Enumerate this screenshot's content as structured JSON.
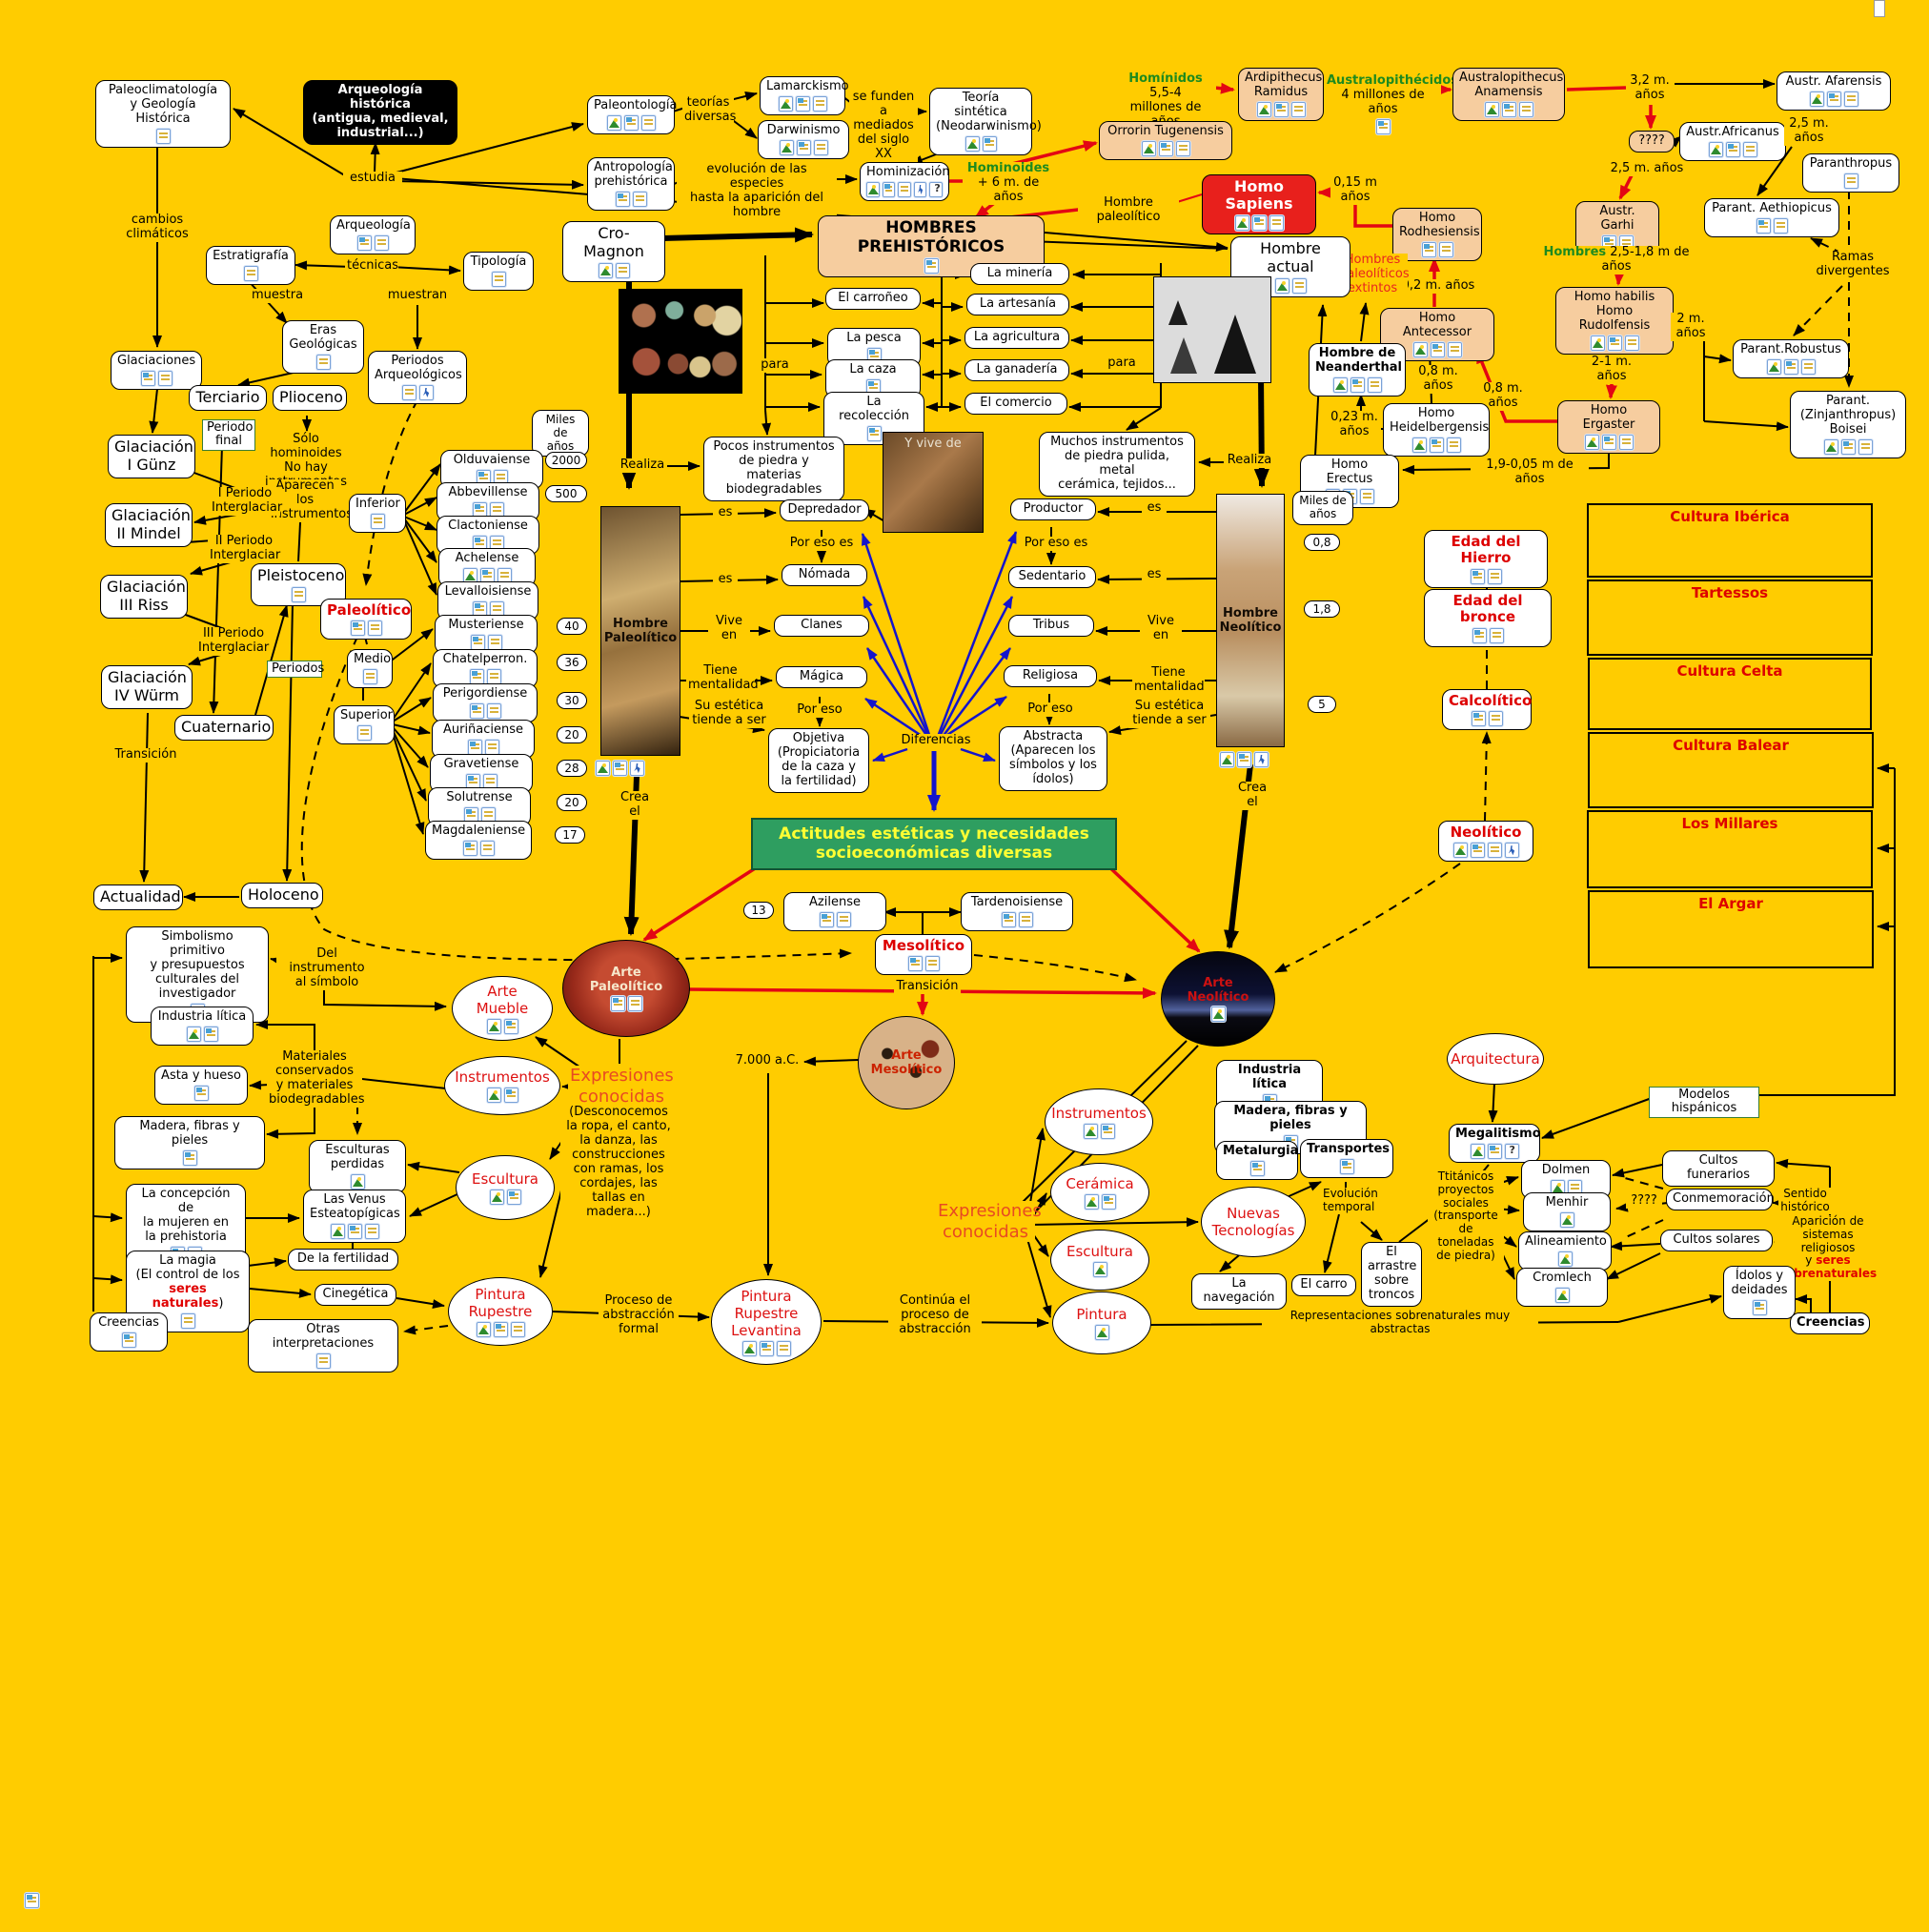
{
  "palette": {
    "background": "#FFCC00",
    "node_fill": "#FFFFFF",
    "peach": "#F6CD9F",
    "red_box": "#E8201C",
    "red_text": "#DD0000",
    "green_text": "#1E8A1E",
    "green_box": "#2E9E60",
    "green_box_text": "#FFFF33",
    "orange_text": "#E84A22",
    "blue_arrow": "#1414CC",
    "red_arrow": "#E30613"
  },
  "tl": {
    "paleoclimatologia": "Paleoclimatología\ny Geología Histórica",
    "arqueologia_historica": "Arqueología histórica\n(antigua, medieval,\nindustrial...)",
    "estudia": "estudia",
    "arqueologia": "Arqueología",
    "tecnicas": "técnicas",
    "estratigrafia": "Estratigrafía",
    "tipologia": "Tipología",
    "muestra": "muestra",
    "muestran": "muestran",
    "cambios": "cambios\nclimáticos",
    "paleontologia": "Paleontología",
    "teorias": "teorías\ndiversas",
    "lamarckismo": "Lamarckismo",
    "darwinismo": "Darwinismo",
    "se_funden": "se funden\na mediados\ndel siglo XX",
    "teoria_sintetica": "Teoría sintética\n(Neodarwinismo)",
    "antropologia": "Antropología\nprehistórica",
    "evolucion": "evolución de las especies\nhasta la aparición del hombre",
    "hominizacion": "Hominización",
    "hominoides_g": "Hominoides",
    "hominoides_r": "+ 6 m. de años",
    "cro_magnon": "Cro-Magnon"
  },
  "ho": {
    "hominidos_g": "Homínidos",
    "hominidos_r1": " 5,5-4",
    "hominidos_r2": "millones de años",
    "ardipithecus": "Ardipithecus\nRamidus",
    "australopithecidos_g": "Australopithécidos",
    "australopithecidos_r": "4 millones de años",
    "anamensis": "Australopithecus\nAnamensis",
    "orrorin": "Orrorin Tugenensis",
    "l_32": "3,2 m.\naños",
    "afarensis": "Austr. Afarensis",
    "q4": "????",
    "l_25a": "2,5 m. años",
    "africanus": "Austr.Africanus",
    "l_25b": "2,5 m.\naños",
    "paranthropus": "Paranthropus",
    "aethiopicus": "Parant. Aethiopicus",
    "ramas": "Ramas\ndivergentes",
    "garhi": "Austr. Garhi",
    "hombres_g": "Hombres",
    "hombres_r": " 2,5-1,8 m de años",
    "habilis": "Homo habilis\nHomo Rudolfensis",
    "l_2m": "2 m.\naños",
    "robustus": "Parant.Robustus",
    "l_21": "2-1 m. años",
    "ergaster": "Homo Ergaster",
    "boisei": "Parant.\n(Zinjanthropus)\nBoisei",
    "l_19": "1,9-0,05 m de años",
    "homo_sapiens": "Homo Sapiens",
    "l_015": "0,15 m\naños",
    "rodhesiensis": "Homo\nRodhesiensis",
    "l_02": "0,2 m. años",
    "antecessor": "Homo Antecessor",
    "l_08a": "0,8 m. años",
    "l_08b": "0,8 m. años",
    "neanderthal": "Hombre de\nNeanderthal",
    "l_023": "0,23 m.\naños",
    "heidelbergensis": "Homo\nHeidelbergensis",
    "erectus": "Homo Erectus",
    "extintos": "Hombres\npaleolíticos\nextintos",
    "hombre_actual": "Hombre actual",
    "hombre_paleolitico": "Hombre paleolítico"
  },
  "gl": {
    "glaciaciones": "Glaciaciones",
    "eras": "Eras\nGeológicas",
    "periodos_arq": "Periodos\nArqueológicos",
    "terciario": "Terciario",
    "plioceno": "Plioceno",
    "periodo_final": "Periodo\nfinal",
    "solo_hominoides": "Sólo hominoides\nNo hay\ninstrumentos",
    "aparecen": "Aparecen los\ninstrumentos",
    "g1": "Glaciación\nI Günz",
    "ip1": "I Periodo\nInterglaciar",
    "g2": "Glaciación\nII Mindel",
    "ip2": "II Periodo\nInterglaciar",
    "g3": "Glaciación\nIII Riss",
    "ip3": "III Periodo\nInterglaciar",
    "g4": "Glaciación\nIV Würm",
    "pleistoceno": "Pleistoceno",
    "periodos": "Periodos",
    "paleolitico": "Paleolítico",
    "inferior": "Inferior",
    "medio": "Medio",
    "superior": "Superior",
    "cuaternario": "Cuaternario",
    "transicion": "Transición",
    "actualidad": "Actualidad",
    "holoceno": "Holoceno"
  },
  "ind": {
    "miles": "Miles de\naños",
    "items": [
      "Olduvaiense",
      "Abbevillense",
      "Clactoniense",
      "Achelense",
      "Levalloisiense",
      "Musteriense",
      "Chatelperron.",
      "Perigordiense",
      "Auriñaciense",
      "Gravetiense",
      "Solutrense",
      "Magdaleniense"
    ],
    "n2000": "2000",
    "n500": "500",
    "n40": "40",
    "n36": "36",
    "n30": "30",
    "n20a": "20",
    "n28": "28",
    "n20b": "20",
    "n17": "17"
  },
  "men": {
    "titulo": "HOMBRES PREHISTÓRICOS",
    "mineria": "La minería",
    "carroneo": "El carroñeo",
    "artesania": "La artesanía",
    "pesca": "La pesca",
    "agricultura": "La agricultura",
    "caza": "La caza",
    "ganaderia": "La ganadería",
    "recoleccion": "La recolección",
    "comercio": "El comercio",
    "para_l": "para",
    "para_r": "para"
  },
  "ls": {
    "pocos": "Pocos instrumentos\nde piedra y materias\nbiodegradables",
    "muchos": "Muchos instrumentos\nde piedra pulida, metal\ncerámica, tejidos...",
    "realiza_l": "Realiza",
    "realiza_r": "Realiza",
    "vive_de": "Y vive de",
    "es_l1": "es",
    "es_l2": "es",
    "es_r1": "es",
    "es_r2": "es",
    "depredador": "Depredador",
    "productor": "Productor",
    "por_eso_es_l": "Por eso es",
    "por_eso_es_r": "Por eso es",
    "nomada": "Nómada",
    "sedentario": "Sedentario",
    "vive_l": "Vive\nen",
    "vive_r": "Vive\nen",
    "clanes": "Clanes",
    "tribus": "Tribus",
    "tiene_l": "Tiene\nmentalidad",
    "tiene_r": "Tiene\nmentalidad",
    "magica": "Mágica",
    "religiosa": "Religiosa",
    "por_eso_l": "Por eso",
    "por_eso_r": "Por eso",
    "estetica_l": "Su estética\ntiende a ser",
    "estetica_r": "Su estética\ntiende a ser",
    "objetiva": "Objetiva\n(Propiciatoria\nde la caza y\nla fertilidad)",
    "abstracta": "Abstracta\n(Aparecen los\nsímbolos y los\nídolos)",
    "diferencias": "Diferencias",
    "crea_l": "Crea\nel",
    "crea_r": "Crea\nel",
    "strip_p": "Hombre\nPaleolítico",
    "strip_n": "Hombre\nNeolítico",
    "miles_r": "Miles de\naños",
    "n08": "0,8",
    "n18": "1,8",
    "n5": "5"
  },
  "ages": {
    "hierro": "Edad del Hierro",
    "bronce": "Edad del bronce",
    "calcolitico": "Calcolítico",
    "neolitico": "Neolítico"
  },
  "cu": {
    "iberica": "Cultura Ibérica",
    "tartessos": "Tartessos",
    "celta": "Cultura Celta",
    "balear": "Cultura Balear",
    "millares": "Los Millares",
    "argar": "El Argar",
    "modelos": "Modelos hispánicos"
  },
  "me": {
    "actitudes": "Actitudes estéticas y necesidades\nsocioeconómicas diversas",
    "n13": "13",
    "azilense": "Azilense",
    "tardenoisiense": "Tardenoisiense",
    "mesolitico": "Mesolítico",
    "transicion": "Transición"
  },
  "pa": {
    "arte_paleolitico": "Arte\nPaleolítico",
    "simbolismo": "Simbolismo primitivo\ny presupuestos\nculturales del\ninvestigador",
    "del_instrumento": "Del instrumento\nal símbolo",
    "industria_litica": "Industria lítica",
    "materiales": "Materiales\nconservados\ny materiales\nbiodegradables",
    "asta": "Asta y hueso",
    "madera": "Madera, fibras y pieles",
    "arte_mueble": "Arte\nMueble",
    "instrumentos": "Instrumentos",
    "expresiones": "Expresiones\nconocidas",
    "desconocemos": "(Desconocemos\nla ropa, el canto,\nla danza, las\nconstrucciones\ncon ramas, los\ncordajes, las\ntallas en\nmadera...)",
    "escultura": "Escultura",
    "esc_perdidas": "Esculturas\nperdidas",
    "venus": "Las Venus\nEsteatopígicas",
    "concepcion": "La concepción de\nla mujeren en\nla prehistoria",
    "fertilidad": "De la fertilidad",
    "magia_1": "La magia\n(El control de los\n",
    "magia_2": "seres naturales",
    "magia_3": ")",
    "cinegetica": "Cinegética",
    "creencias": "Creencias",
    "otras": "Otras interpretaciones",
    "pintura_rupestre": "Pintura\nRupestre",
    "proceso": "Proceso de\nabstracción\nformal",
    "l7000": "7.000 a.C.",
    "arte_mesolitico": "Arte\nMesolítico",
    "prl": "Pintura\nRupestre\nLevantina",
    "continua": "Continúa el\nproceso de\nabstracción"
  },
  "na": {
    "arte_neolitico": "Arte\nNeolítico",
    "expresiones": "Expresiones\nconocidas",
    "instrumentos": "Instrumentos",
    "industria_litica": "Industria lítica",
    "madera": "Madera, fibras y pieles",
    "metalurgia": "Metalurgia",
    "transportes": "Transportes",
    "ceramica": "Cerámica",
    "nuevas": "Nuevas\nTecnologías",
    "evolucion": "Evolución\ntemporal",
    "escultura": "Escultura",
    "pintura": "Pintura",
    "navegacion": "La navegación",
    "carro": "El carro",
    "arrastre": "El\narrastre\nsobre\ntroncos",
    "titanicos": "Ttitánicos\nproyectos\nsociales\n(transporte\nde toneladas\nde piedra)",
    "representaciones": "Representaciones sobrenaturales muy abstractas"
  },
  "mg": {
    "arquitectura": "Arquitectura",
    "megalitismo": "Megalitismo",
    "dolmen": "Dolmen",
    "menhir": "Menhir",
    "alineamiento": "Alineamiento",
    "cromlech": "Cromlech",
    "funerarios": "Cultos funerarios",
    "conmemoracion": "Conmemoración",
    "q2": "????",
    "solares": "Cultos solares",
    "sentido": "Sentido\nhistórico",
    "aparicion_1": "Aparición de\nsistemas religiosos\ny ",
    "aparicion_2": "seres\nsobrenaturales",
    "idolos": "Ídolos y\ndeidades",
    "creencias": "Creencias"
  }
}
